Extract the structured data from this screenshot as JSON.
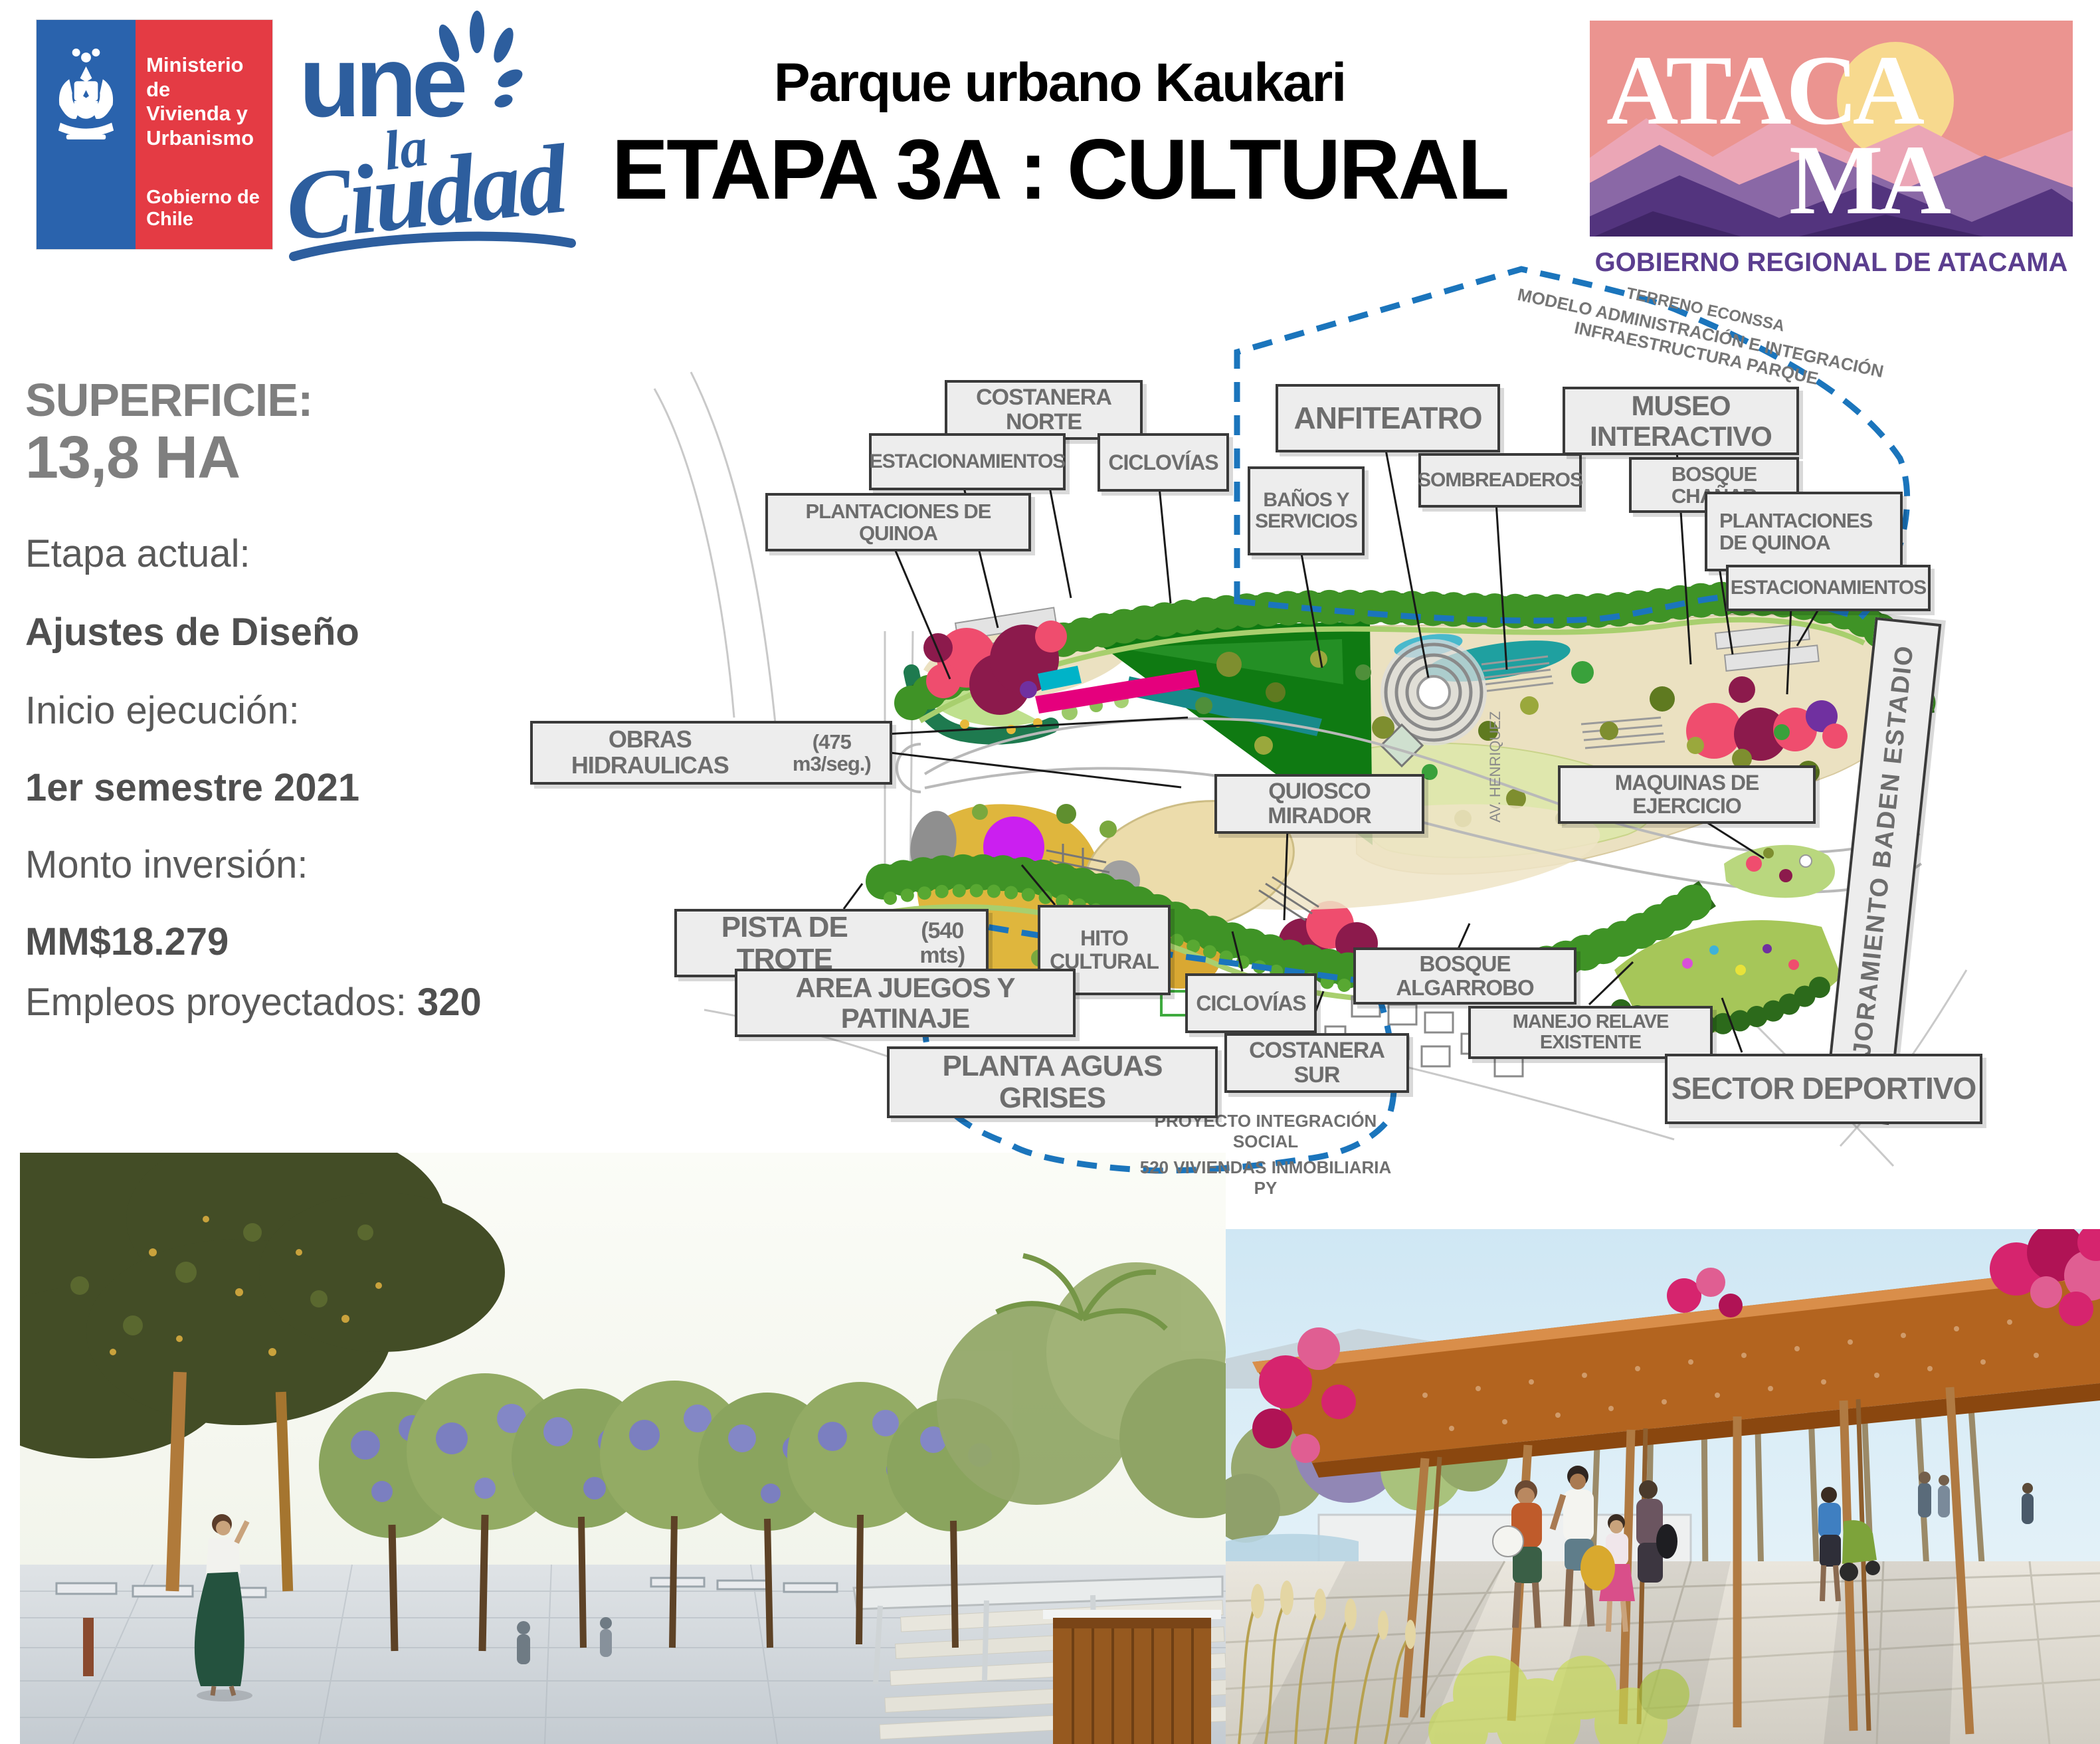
{
  "header": {
    "ministry": {
      "name_line1": "Ministerio de",
      "name_line2": "Vivienda y",
      "name_line3": "Urbanismo",
      "gov": "Gobierno de Chile"
    },
    "une": {
      "une": "une",
      "la": "la",
      "ciudad": "Ciudad"
    },
    "title_line1": "Parque urbano Kaukari",
    "title_line2": "ETAPA 3A : CULTURAL",
    "atacama": {
      "word_top": "ATACA",
      "word_bottom": "MA",
      "caption": "GOBIERNO REGIONAL DE ATACAMA"
    }
  },
  "info": {
    "superficie_label": "SUPERFICIE:",
    "superficie_value": "13,8 HA",
    "etapa_label": "Etapa actual:",
    "etapa_value": "Ajustes de Diseño",
    "inicio_label": "Inicio ejecución:",
    "inicio_value": "1er semestre 2021",
    "monto_label": "Monto inversión:",
    "monto_value": "MM$18.279",
    "empleos_label": "Empleos proyectados:",
    "empleos_value": "320"
  },
  "map": {
    "notes": {
      "terreno": "TERRENO ECONSSA",
      "modelo": "MODELO ADMINISTRACIÓN E INTEGRACIÓN INFRAESTRUCTURA PARQUE",
      "proyecto_line1": "PROYECTO INTEGRACIÓN SOCIAL",
      "proyecto_line2": "520 VIVIENDAS INMOBILIARIA PY",
      "street": "AV. HENRIQUEZ"
    },
    "labels": {
      "costanera_norte": {
        "text": "COSTANERA NORTE"
      },
      "estacionamientos_norte": {
        "text": "ESTACIONAMIENTOS"
      },
      "ciclovias_norte": {
        "text": "CICLOVÍAS"
      },
      "plantaciones_quinoa_oeste": {
        "text": "PLANTACIONES DE QUINOA"
      },
      "anfiteatro": {
        "text": "ANFITEATRO"
      },
      "banos_servicios": {
        "line1": "BAÑOS Y",
        "line2": "SERVICIOS"
      },
      "sombreaderos": {
        "text": "SOMBREADEROS"
      },
      "museo_interactivo": {
        "text": "MUSEO INTERACTIVO"
      },
      "bosque_chanar": {
        "text": "BOSQUE CHAÑAR"
      },
      "plantaciones_quinoa_este": {
        "line1": "PLANTACIONES",
        "line2": "DE QUINOA"
      },
      "estacionamientos_este": {
        "text": "ESTACIONAMIENTOS"
      },
      "obras_hidraulicas": {
        "text": "OBRAS HIDRAULICAS",
        "sub": "(475 m3/seg.)"
      },
      "quiosco_mirador": {
        "text": "QUIOSCO MIRADOR"
      },
      "maquinas_ejercicio": {
        "text": "MAQUINAS DE EJERCICIO"
      },
      "mejoramiento_baden": {
        "text": "MEJORAMIENTO BADEN ESTADIO"
      },
      "pista_trote": {
        "text": "PISTA DE TROTE",
        "sub": "(540 mts)"
      },
      "hito_cultural": {
        "line1": "HITO",
        "line2": "CULTURAL"
      },
      "area_juegos": {
        "text": "AREA JUEGOS Y PATINAJE"
      },
      "ciclovias_sur": {
        "text": "CICLOVÍAS"
      },
      "bosque_algarrobo": {
        "text": "BOSQUE ALGARROBO"
      },
      "manejo_relave": {
        "text": "MANEJO RELAVE EXISTENTE"
      },
      "planta_aguas_grises": {
        "text": "PLANTA AGUAS GRISES"
      },
      "costanera_sur": {
        "text": "COSTANERA SUR"
      },
      "sector_deportivo": {
        "text": "SECTOR DEPORTIVO"
      }
    }
  },
  "colors": {
    "boundary_blue": "#1b75bc",
    "label_text_gray": "#6d6d6d",
    "ministry_blue": "#2a63ad",
    "ministry_red": "#e43b44",
    "une_blue": "#2d5e9e",
    "atacama_purple": "#5b3e8f",
    "info_gray": "#595959"
  }
}
